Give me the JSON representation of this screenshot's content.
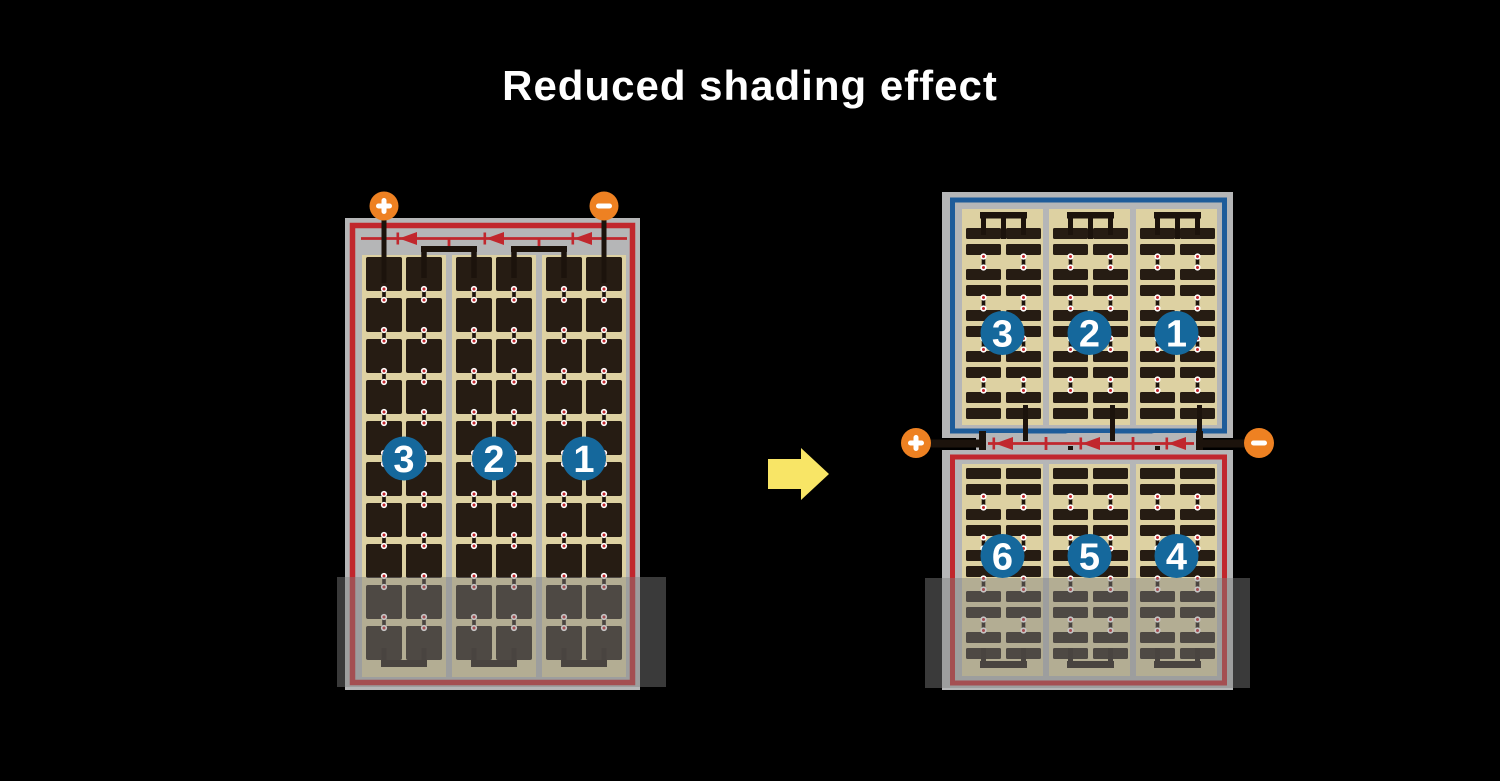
{
  "title": "Reduced shading effect",
  "colors": {
    "background": "#000000",
    "module_frame_gray": "#b5b6b7",
    "cell_background_tan": "#ddd1a2",
    "cell_dark": "#261c13",
    "busbar_black": "#1c130c",
    "string_red": "#c1272d",
    "string_blue": "#1e5c9a",
    "badge_blue": "#15689c",
    "badge_text": "#ffffff",
    "terminal_orange": "#ee8122",
    "terminal_symbol": "#ffffff",
    "connector_white": "#ffffff",
    "connector_red": "#c1272d",
    "flow_arrow_yellow": "#f8e566",
    "shade_overlay": "rgba(128,128,128,0.45)",
    "title_text": "#ffffff"
  },
  "left_module": {
    "cell_columns": 6,
    "cell_rows": 10,
    "sections": [
      {
        "label": "3"
      },
      {
        "label": "2"
      },
      {
        "label": "1"
      }
    ],
    "terminals": [
      {
        "type": "plus",
        "symbol": "+"
      },
      {
        "type": "minus",
        "symbol": "−"
      }
    ],
    "bypass_diode_count": 3
  },
  "right_module": {
    "bar_rows_per_half": 10,
    "top_half": {
      "sections": [
        {
          "label": "3"
        },
        {
          "label": "2"
        },
        {
          "label": "1"
        }
      ]
    },
    "bottom_half": {
      "sections": [
        {
          "label": "6"
        },
        {
          "label": "5"
        },
        {
          "label": "4"
        }
      ]
    },
    "terminals": [
      {
        "type": "plus",
        "symbol": "+"
      },
      {
        "type": "minus",
        "symbol": "−"
      }
    ],
    "bypass_diode_count": 3
  },
  "flow_arrow": {
    "icon": "right-arrow-icon"
  }
}
